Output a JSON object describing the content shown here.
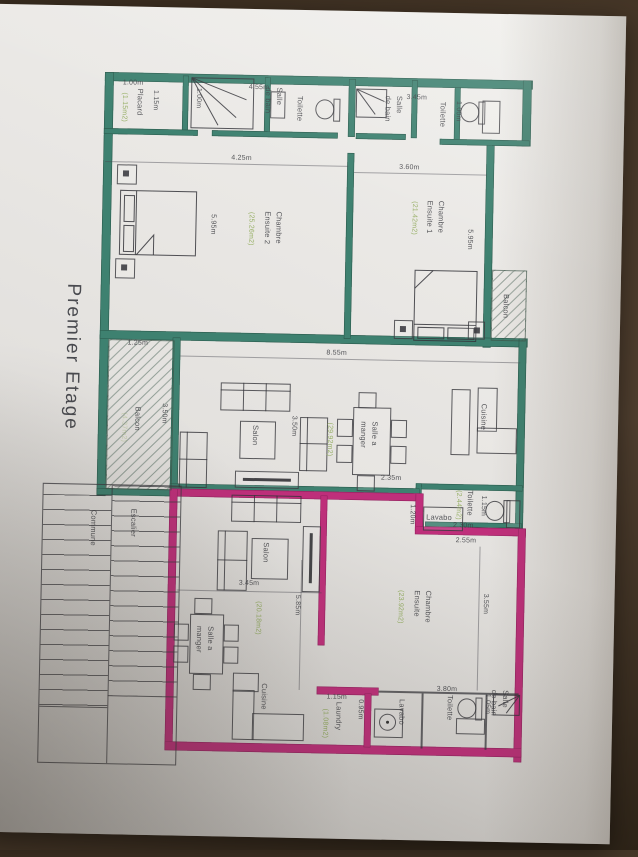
{
  "plan": {
    "title": "Premier Etage",
    "colors": {
      "wall_green": "#3e8170",
      "wall_pink": "#bf2f7b",
      "area_text": "#8CA855",
      "ink": "#3e3f44",
      "paper": "#e7e5e2",
      "background": "#46372a"
    },
    "labels": [
      {
        "n": "floor-title",
        "t": "Premier Etage",
        "x": 56,
        "y": 288,
        "o": "v",
        "c": "title"
      },
      {
        "n": "dim-placard-width",
        "t": "1.00m",
        "x": 116,
        "y": 82,
        "o": "h",
        "c": "dim"
      },
      {
        "n": "dim-top-width",
        "t": "4.55m",
        "x": 242,
        "y": 84,
        "o": "h",
        "c": "dim"
      },
      {
        "n": "dim-sdb2-width",
        "t": "3.45m",
        "x": 400,
        "y": 91,
        "o": "h",
        "c": "dim"
      },
      {
        "n": "dim-placard-depth",
        "t": "1.15m",
        "x": 143,
        "y": 93,
        "o": "v",
        "c": "dim"
      },
      {
        "n": "room-placard",
        "t": "Placard",
        "x": 128,
        "y": 92,
        "o": "v",
        "c": "room"
      },
      {
        "n": "area-placard",
        "t": "(1.15m2)",
        "x": 112,
        "y": 96,
        "o": "v",
        "c": "area"
      },
      {
        "n": "dim-sdb1-shower",
        "t": "1.00m",
        "x": 186,
        "y": 90,
        "o": "v",
        "c": "dim"
      },
      {
        "n": "room-salle-de-bain-1",
        "t": "Salle\nde bain",
        "x": 256,
        "y": 88,
        "o": "v",
        "c": "room"
      },
      {
        "n": "room-toilette-1",
        "t": "Toilette",
        "x": 288,
        "y": 96,
        "o": "v",
        "c": "room"
      },
      {
        "n": "room-salle-de-bain-2",
        "t": "Salle\nde bain",
        "x": 376,
        "y": 94,
        "o": "v",
        "c": "room"
      },
      {
        "n": "room-toilette-2",
        "t": "Toilette",
        "x": 431,
        "y": 99,
        "o": "v",
        "c": "room"
      },
      {
        "n": "dim-toilette-2",
        "t": "1.00m",
        "x": 446,
        "y": 98,
        "o": "v",
        "c": "dim"
      },
      {
        "n": "dim-chambre2-width",
        "t": "4.25m",
        "x": 226,
        "y": 155,
        "o": "h",
        "c": "dim"
      },
      {
        "n": "dim-chambre1-width",
        "t": "3.60m",
        "x": 394,
        "y": 161,
        "o": "h",
        "c": "dim"
      },
      {
        "n": "room-chambre-ensuite-2",
        "t": "Chambre\nEnsuite 2",
        "x": 258,
        "y": 212,
        "o": "v",
        "c": "room"
      },
      {
        "n": "area-chambre-ensuite-2",
        "t": "(25.26m2)",
        "x": 241,
        "y": 213,
        "o": "v",
        "c": "area"
      },
      {
        "n": "dim-chambre2-height",
        "t": "5.95m",
        "x": 203,
        "y": 216,
        "o": "v",
        "c": "dim"
      },
      {
        "n": "room-chambre-ensuite-1",
        "t": "Chambre\nEnsuite 1",
        "x": 420,
        "y": 198,
        "o": "v",
        "c": "room"
      },
      {
        "n": "area-chambre-ensuite-1",
        "t": "(21.42m2)",
        "x": 404,
        "y": 199,
        "o": "v",
        "c": "area"
      },
      {
        "n": "dim-chambre1-height",
        "t": "5.95m",
        "x": 460,
        "y": 226,
        "o": "v",
        "c": "dim"
      },
      {
        "n": "room-balcon-right",
        "t": "Balcon",
        "x": 498,
        "y": 290,
        "o": "v",
        "c": "room"
      },
      {
        "n": "dim-balcon-left-width",
        "t": "1.25m",
        "x": 126,
        "y": 342,
        "o": "h",
        "c": "dim"
      },
      {
        "n": "dim-living-width",
        "t": "8.55m",
        "x": 325,
        "y": 348,
        "o": "h",
        "c": "dim"
      },
      {
        "n": "room-balcon-left",
        "t": "Balcon",
        "x": 132,
        "y": 410,
        "o": "v",
        "c": "room"
      },
      {
        "n": "area-balcon-left",
        "t": "(4.37m2)",
        "x": 118,
        "y": 416,
        "o": "v",
        "c": "area fade"
      },
      {
        "n": "dim-balcon-left-height",
        "t": "3.50m",
        "x": 158,
        "y": 406,
        "o": "v",
        "c": "dim"
      },
      {
        "n": "dim-salon1",
        "t": "3.50m",
        "x": 288,
        "y": 416,
        "o": "v",
        "c": "dim"
      },
      {
        "n": "room-salon-1",
        "t": "Salon",
        "x": 250,
        "y": 426,
        "o": "v",
        "c": "room"
      },
      {
        "n": "area-living",
        "t": "(29.92m2)",
        "x": 324,
        "y": 422,
        "o": "v",
        "c": "area"
      },
      {
        "n": "room-salle-a-manger-1",
        "t": "Salle a\nmanger",
        "x": 358,
        "y": 420,
        "o": "v",
        "c": "room"
      },
      {
        "n": "room-cuisine-1",
        "t": "Cuisine",
        "x": 478,
        "y": 400,
        "o": "v",
        "c": "room"
      },
      {
        "n": "dim-235",
        "t": "2.35m",
        "x": 382,
        "y": 472,
        "o": "h",
        "c": "dim"
      },
      {
        "n": "dim-120",
        "t": "1.20m",
        "x": 408,
        "y": 502,
        "o": "v",
        "c": "dim"
      },
      {
        "n": "room-lavabo-mid",
        "t": "Lavabo",
        "x": 428,
        "y": 509,
        "o": "h",
        "c": "room"
      },
      {
        "n": "area-toilette-mid",
        "t": "(2.44m2)",
        "x": 454,
        "y": 487,
        "o": "v",
        "c": "area"
      },
      {
        "n": "room-toilette-mid",
        "t": "Toilette",
        "x": 466,
        "y": 487,
        "o": "v",
        "c": "room"
      },
      {
        "n": "dim-toilette-mid",
        "t": "1.15m",
        "x": 479,
        "y": 492,
        "o": "v",
        "c": "dim"
      },
      {
        "n": "dim-230",
        "t": "2.30m",
        "x": 455,
        "y": 518,
        "o": "h",
        "c": "dim"
      },
      {
        "n": "dim-255",
        "t": "2.55m",
        "x": 458,
        "y": 533,
        "o": "h",
        "c": "dim"
      },
      {
        "n": "dim-salon2-width",
        "t": "3.45m",
        "x": 242,
        "y": 580,
        "o": "h",
        "c": "dim"
      },
      {
        "n": "dim-585",
        "t": "5.85m",
        "x": 295,
        "y": 595,
        "o": "v",
        "c": "dim"
      },
      {
        "n": "room-salon-2",
        "t": "Salon",
        "x": 263,
        "y": 543,
        "o": "v",
        "c": "room"
      },
      {
        "n": "area-salon-2",
        "t": "(20.18m2)",
        "x": 256,
        "y": 602,
        "o": "v",
        "c": "area"
      },
      {
        "n": "room-chambre-ensuite-3",
        "t": "Chambre\nEnsuite",
        "x": 415,
        "y": 588,
        "o": "v",
        "c": "room"
      },
      {
        "n": "area-chambre-ensuite-3",
        "t": "(23.92m2)",
        "x": 398,
        "y": 588,
        "o": "v",
        "c": "area"
      },
      {
        "n": "dim-chambre3-height",
        "t": "3.55m",
        "x": 483,
        "y": 590,
        "o": "v",
        "c": "dim"
      },
      {
        "n": "room-salle-a-manger-2",
        "t": "Salle a\nmanger",
        "x": 198,
        "y": 628,
        "o": "v",
        "c": "room"
      },
      {
        "n": "room-cuisine-2",
        "t": "Cuisine",
        "x": 264,
        "y": 684,
        "o": "v",
        "c": "room"
      },
      {
        "n": "room-escalier",
        "t": "Escalier",
        "x": 130,
        "y": 512,
        "o": "v",
        "c": "room"
      },
      {
        "n": "room-commune",
        "t": "Commune",
        "x": 90,
        "y": 514,
        "o": "v",
        "c": "room"
      },
      {
        "n": "dim-380",
        "t": "3.80m",
        "x": 442,
        "y": 682,
        "o": "h",
        "c": "dim"
      },
      {
        "n": "dim-laundry-width",
        "t": "1.15m",
        "x": 332,
        "y": 692,
        "o": "h",
        "c": "dim"
      },
      {
        "n": "room-laundry",
        "t": "Laundry",
        "x": 339,
        "y": 701,
        "o": "v",
        "c": "room"
      },
      {
        "n": "area-laundry",
        "t": "(1.08m2)",
        "x": 325,
        "y": 708,
        "o": "v",
        "c": "area"
      },
      {
        "n": "dim-095",
        "t": "0.95m",
        "x": 360,
        "y": 698,
        "o": "v",
        "c": "dim"
      },
      {
        "n": "room-lavabo-2",
        "t": "Lavabo",
        "x": 402,
        "y": 697,
        "o": "v",
        "c": "room"
      },
      {
        "n": "room-toilette-3",
        "t": "Toilette",
        "x": 450,
        "y": 692,
        "o": "v",
        "c": "room"
      },
      {
        "n": "room-salle-de-bain-3",
        "t": "Salle\nde bain",
        "x": 494,
        "y": 686,
        "o": "v",
        "c": "room"
      },
      {
        "n": "dim-105",
        "t": "1.05m",
        "x": 487,
        "y": 690,
        "o": "v",
        "c": "dim"
      }
    ]
  }
}
